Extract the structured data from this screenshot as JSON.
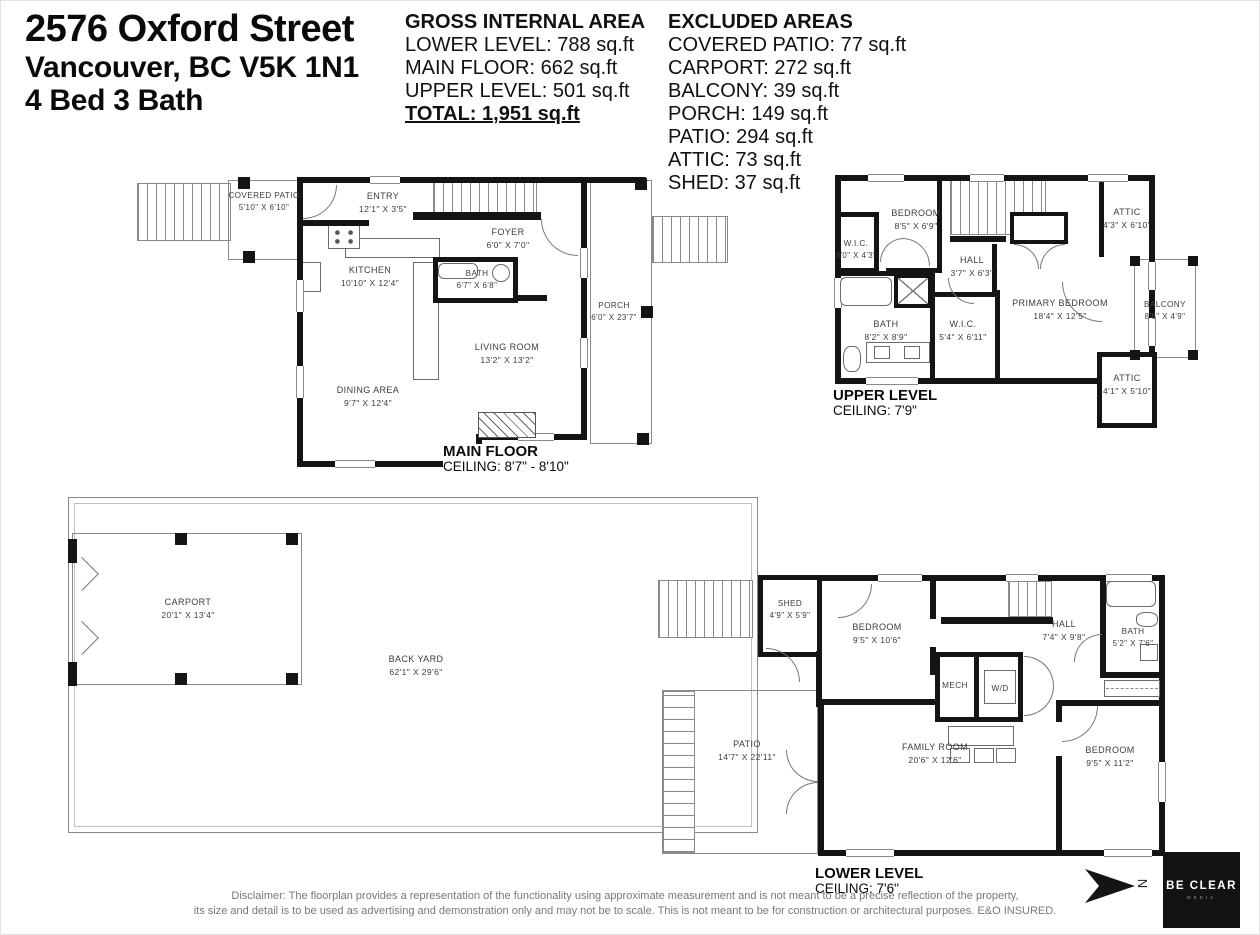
{
  "header": {
    "address1": "2576 Oxford Street",
    "address2": "Vancouver, BC V5K 1N1",
    "address3": "4 Bed 3 Bath",
    "gia": {
      "title": "GROSS INTERNAL AREA",
      "lines": [
        "LOWER LEVEL: 788 sq.ft",
        "MAIN FLOOR: 662 sq.ft",
        "UPPER LEVEL: 501 sq.ft"
      ],
      "total": "TOTAL: 1,951 sq.ft"
    },
    "excluded": {
      "title": "EXCLUDED AREAS",
      "lines": [
        "COVERED PATIO: 77 sq.ft",
        "CARPORT: 272 sq.ft",
        "BALCONY: 39 sq.ft",
        "PORCH: 149 sq.ft",
        "PATIO: 294 sq.ft",
        "ATTIC: 73 sq.ft",
        "SHED: 37 sq.ft"
      ]
    }
  },
  "floors": {
    "main": {
      "label": "MAIN FLOOR",
      "ceiling": "CEILING: 8'7\" - 8'10\"",
      "rooms": {
        "covered_patio": {
          "name": "COVERED PATIO",
          "dims": "5'10\" X 6'10\""
        },
        "entry": {
          "name": "ENTRY",
          "dims": "12'1\" X 3'5\""
        },
        "foyer": {
          "name": "FOYER",
          "dims": "6'0\" X 7'0\""
        },
        "kitchen": {
          "name": "KITCHEN",
          "dims": "10'10\" X 12'4\""
        },
        "bath": {
          "name": "BATH",
          "dims": "6'7\" X 6'8\""
        },
        "living_room": {
          "name": "LIVING ROOM",
          "dims": "13'2\" X 13'2\""
        },
        "dining_area": {
          "name": "DINING AREA",
          "dims": "9'7\" X 12'4\""
        },
        "porch": {
          "name": "PORCH",
          "dims": "6'0\" X 23'7\""
        }
      }
    },
    "upper": {
      "label": "UPPER LEVEL",
      "ceiling": "CEILING: 7'9\"",
      "rooms": {
        "bedroom": {
          "name": "BEDROOM",
          "dims": "8'5\" X 6'9\""
        },
        "wic_small": {
          "name": "W.I.C.",
          "dims": "3'0\" X 4'3\""
        },
        "hall": {
          "name": "HALL",
          "dims": "3'7\" X 6'3\""
        },
        "attic_top": {
          "name": "ATTIC",
          "dims": "4'3\" X 6'10\""
        },
        "primary_bedroom": {
          "name": "PRIMARY BEDROOM",
          "dims": "18'4\" X 12'5\""
        },
        "balcony": {
          "name": "BALCONY",
          "dims": "8'6\" X 4'9\""
        },
        "bath": {
          "name": "BATH",
          "dims": "8'2\" X 8'9\""
        },
        "wic_large": {
          "name": "W.I.C.",
          "dims": "5'4\" X 6'11\""
        },
        "attic_bottom": {
          "name": "ATTIC",
          "dims": "4'1\" X 5'10\""
        }
      }
    },
    "lower": {
      "label": "LOWER LEVEL",
      "ceiling": "CEILING: 7'6\"",
      "rooms": {
        "carport": {
          "name": "CARPORT",
          "dims": "20'1\" X 13'4\""
        },
        "back_yard": {
          "name": "BACK YARD",
          "dims": "62'1\" X 29'6\""
        },
        "shed": {
          "name": "SHED",
          "dims": "4'9\" X 5'9\""
        },
        "bedroom_left": {
          "name": "BEDROOM",
          "dims": "9'5\" X 10'6\""
        },
        "hall": {
          "name": "HALL",
          "dims": "7'4\" X 9'8\""
        },
        "bath": {
          "name": "BATH",
          "dims": "5'2\" X 7'6\""
        },
        "mech": {
          "name": "MECH"
        },
        "wd": {
          "name": "W/D"
        },
        "family_room": {
          "name": "FAMILY ROOM",
          "dims": "20'6\" X 12'6\""
        },
        "bedroom_right": {
          "name": "BEDROOM",
          "dims": "9'5\" X 11'2\""
        },
        "patio": {
          "name": "PATIO",
          "dims": "14'7\" X 22'11\""
        }
      }
    }
  },
  "footer": {
    "disclaimer1": "Disclaimer: The floorplan provides a representation of the functionality using approximate measurement and is not meant to be a precise reflection of the property,",
    "disclaimer2": "its size and detail is to be used as advertising and demonstration only and may not be to scale. This is not meant to be for construction or architectural purposes. E&O INSURED.",
    "compass": "N",
    "logo1": "BE CLEAR",
    "logo2": "MEDIA"
  },
  "colors": {
    "wall": "#141414",
    "thin_line": "#8a8a8a",
    "label_text": "#3d3d3d",
    "logo_bg": "#121212"
  }
}
